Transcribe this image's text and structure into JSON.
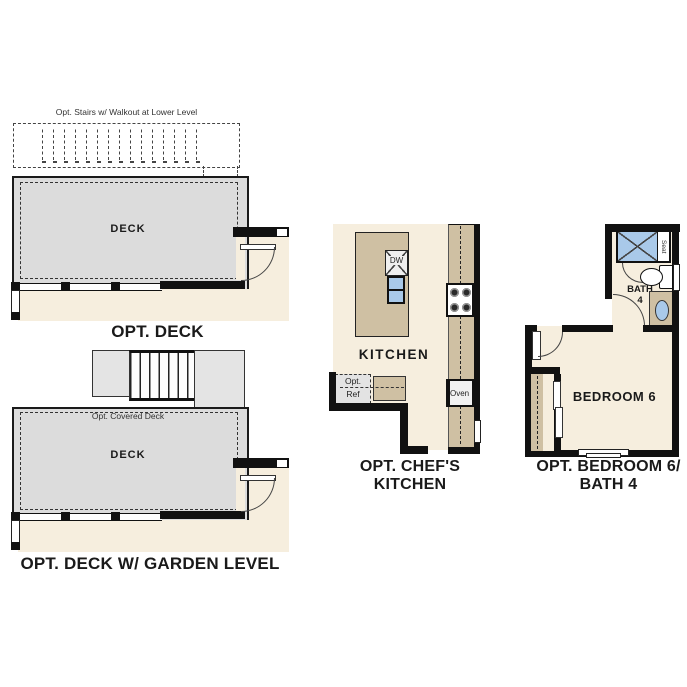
{
  "colors": {
    "floor_cream": "#f6eede",
    "deck_gray": "#dcdcdc",
    "cabinet_tan": "#cfc0a3",
    "fixture_blue": "#a9c9e9",
    "wall_black": "#111111"
  },
  "plans": {
    "opt_deck": {
      "title": "OPT. DECK",
      "stairs_note": "Opt. Stairs w/ Walkout at Lower Level",
      "room_label": "DECK"
    },
    "opt_deck_garden": {
      "title": "OPT. DECK W/ GARDEN LEVEL",
      "covered_note": "Opt. Covered Deck",
      "room_label": "DECK"
    },
    "opt_chefs_kitchen": {
      "title_line1": "OPT. CHEF'S",
      "title_line2": "KITCHEN",
      "room_label": "KITCHEN",
      "dishwasher_label": "DW",
      "ref_label_line1": "Opt.",
      "ref_label_line2": "Ref",
      "oven_label": "Oven"
    },
    "opt_bedroom6_bath4": {
      "title_line1": "OPT. BEDROOM 6/",
      "title_line2": "BATH 4",
      "bedroom_label": "BEDROOM 6",
      "bath_label_line1": "BATH",
      "bath_label_line2": "4",
      "seat_label": "Seat"
    }
  }
}
